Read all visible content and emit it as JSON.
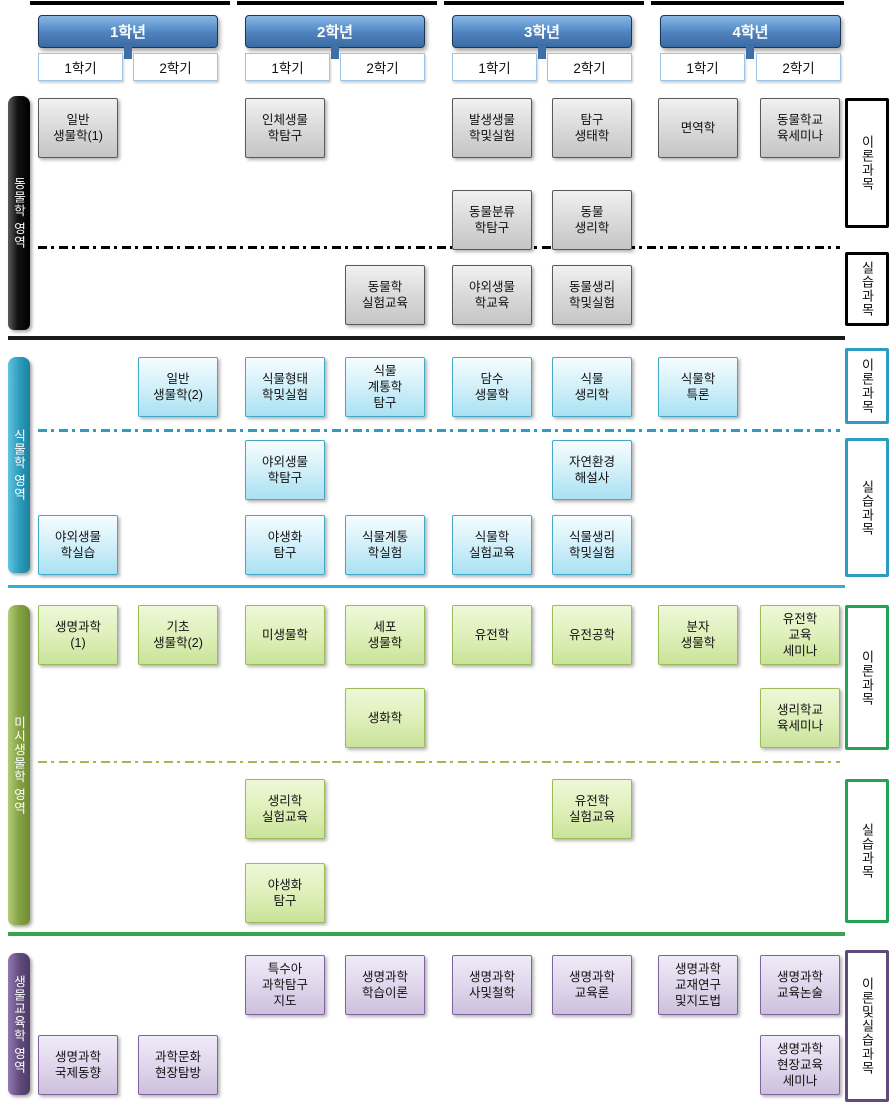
{
  "colors": {
    "year_header": "#4F81BD",
    "animal_section": "#000000",
    "plant_section": "#2E9BC0",
    "micro_section_bar": "#77933C",
    "micro_divider": "#36A54E",
    "bioedu_section": "#60497B",
    "animal_course_fill": "#D9D9D9",
    "plant_course_fill": "#C5E9F6",
    "micro_course_fill": "#D9EDB4",
    "bioedu_course_fill": "#DCD2E8"
  },
  "years": [
    {
      "label": "1학년",
      "semesters": [
        "1학기",
        "2학기"
      ]
    },
    {
      "label": "2학년",
      "semesters": [
        "1학기",
        "2학기"
      ]
    },
    {
      "label": "3학년",
      "semesters": [
        "1학기",
        "2학기"
      ]
    },
    {
      "label": "4학년",
      "semesters": [
        "1학기",
        "2학기"
      ]
    }
  ],
  "sections": [
    {
      "name": "동물학 영역",
      "type_labels": [
        "이론과목",
        "실습과목"
      ],
      "courses": [
        {
          "label": "일반\n생물학(1)",
          "year": 1,
          "semester": 1,
          "group": "theory"
        },
        {
          "label": "인체생물\n학탐구",
          "year": 2,
          "semester": 1,
          "group": "theory"
        },
        {
          "label": "발생생물\n학및실험",
          "year": 3,
          "semester": 1,
          "group": "theory"
        },
        {
          "label": "탐구\n생태학",
          "year": 3,
          "semester": 2,
          "group": "theory"
        },
        {
          "label": "면역학",
          "year": 4,
          "semester": 1,
          "group": "theory"
        },
        {
          "label": "동물학교\n육세미나",
          "year": 4,
          "semester": 2,
          "group": "theory"
        },
        {
          "label": "동물분류\n학탐구",
          "year": 3,
          "semester": 1,
          "group": "theory"
        },
        {
          "label": "동물\n생리학",
          "year": 3,
          "semester": 2,
          "group": "theory"
        },
        {
          "label": "동물학\n실험교육",
          "year": 2,
          "semester": 2,
          "group": "practice"
        },
        {
          "label": "야외생물\n학교육",
          "year": 3,
          "semester": 1,
          "group": "practice"
        },
        {
          "label": "동물생리\n학및실험",
          "year": 3,
          "semester": 2,
          "group": "practice"
        }
      ]
    },
    {
      "name": "식물학 영역",
      "type_labels": [
        "이론과목",
        "실습과목"
      ],
      "courses": [
        {
          "label": "일반\n생물학(2)",
          "year": 1,
          "semester": 2,
          "group": "theory"
        },
        {
          "label": "식물형태\n학및실험",
          "year": 2,
          "semester": 1,
          "group": "theory"
        },
        {
          "label": "식물\n계통학\n탐구",
          "year": 2,
          "semester": 2,
          "group": "theory"
        },
        {
          "label": "담수\n생물학",
          "year": 3,
          "semester": 1,
          "group": "theory"
        },
        {
          "label": "식물\n생리학",
          "year": 3,
          "semester": 2,
          "group": "theory"
        },
        {
          "label": "식물학\n특론",
          "year": 4,
          "semester": 1,
          "group": "theory"
        },
        {
          "label": "야외생물\n학탐구",
          "year": 2,
          "semester": 1,
          "group": "practice"
        },
        {
          "label": "자연환경\n해설사",
          "year": 3,
          "semester": 2,
          "group": "practice"
        },
        {
          "label": "야외생물\n학실습",
          "year": 1,
          "semester": 1,
          "group": "practice"
        },
        {
          "label": "야생화\n탐구",
          "year": 2,
          "semester": 1,
          "group": "practice"
        },
        {
          "label": "식물계통\n학실험",
          "year": 2,
          "semester": 2,
          "group": "practice"
        },
        {
          "label": "식물학\n실험교육",
          "year": 3,
          "semester": 1,
          "group": "practice"
        },
        {
          "label": "식물생리\n학및실험",
          "year": 3,
          "semester": 2,
          "group": "practice"
        }
      ]
    },
    {
      "name": "미시생물학 영역",
      "type_labels": [
        "이론과목",
        "실습과목"
      ],
      "courses": [
        {
          "label": "생명과학\n(1)",
          "year": 1,
          "semester": 1,
          "group": "theory"
        },
        {
          "label": "기초\n생물학(2)",
          "year": 1,
          "semester": 2,
          "group": "theory"
        },
        {
          "label": "미생물학",
          "year": 2,
          "semester": 1,
          "group": "theory"
        },
        {
          "label": "세포\n생물학",
          "year": 2,
          "semester": 2,
          "group": "theory"
        },
        {
          "label": "유전학",
          "year": 3,
          "semester": 1,
          "group": "theory"
        },
        {
          "label": "유전공학",
          "year": 3,
          "semester": 2,
          "group": "theory"
        },
        {
          "label": "분자\n생물학",
          "year": 4,
          "semester": 1,
          "group": "theory"
        },
        {
          "label": "유전학\n교육\n세미나",
          "year": 4,
          "semester": 2,
          "group": "theory"
        },
        {
          "label": "생화학",
          "year": 2,
          "semester": 2,
          "group": "theory"
        },
        {
          "label": "생리학교\n육세미나",
          "year": 4,
          "semester": 2,
          "group": "theory"
        },
        {
          "label": "생리학\n실험교육",
          "year": 2,
          "semester": 1,
          "group": "practice"
        },
        {
          "label": "유전학\n실험교육",
          "year": 3,
          "semester": 2,
          "group": "practice"
        },
        {
          "label": "야생화\n탐구",
          "year": 2,
          "semester": 1,
          "group": "practice"
        }
      ]
    },
    {
      "name": "생물교육학 영역",
      "type_labels": [
        "이론및실습과목"
      ],
      "courses": [
        {
          "label": "특수아\n과학탐구\n지도",
          "year": 2,
          "semester": 1,
          "group": "theory_practice"
        },
        {
          "label": "생명과학\n학습이론",
          "year": 2,
          "semester": 2,
          "group": "theory_practice"
        },
        {
          "label": "생명과학\n사및철학",
          "year": 3,
          "semester": 1,
          "group": "theory_practice"
        },
        {
          "label": "생명과학\n교육론",
          "year": 3,
          "semester": 2,
          "group": "theory_practice"
        },
        {
          "label": "생명과학\n교재연구\n및지도법",
          "year": 4,
          "semester": 1,
          "group": "theory_practice"
        },
        {
          "label": "생명과학\n교육논술",
          "year": 4,
          "semester": 2,
          "group": "theory_practice"
        },
        {
          "label": "생명과학\n국제동향",
          "year": 1,
          "semester": 1,
          "group": "theory_practice"
        },
        {
          "label": "과학문화\n현장탐방",
          "year": 1,
          "semester": 2,
          "group": "theory_practice"
        },
        {
          "label": "생명과학\n현장교육\n세미나",
          "year": 4,
          "semester": 2,
          "group": "theory_practice"
        }
      ]
    }
  ]
}
